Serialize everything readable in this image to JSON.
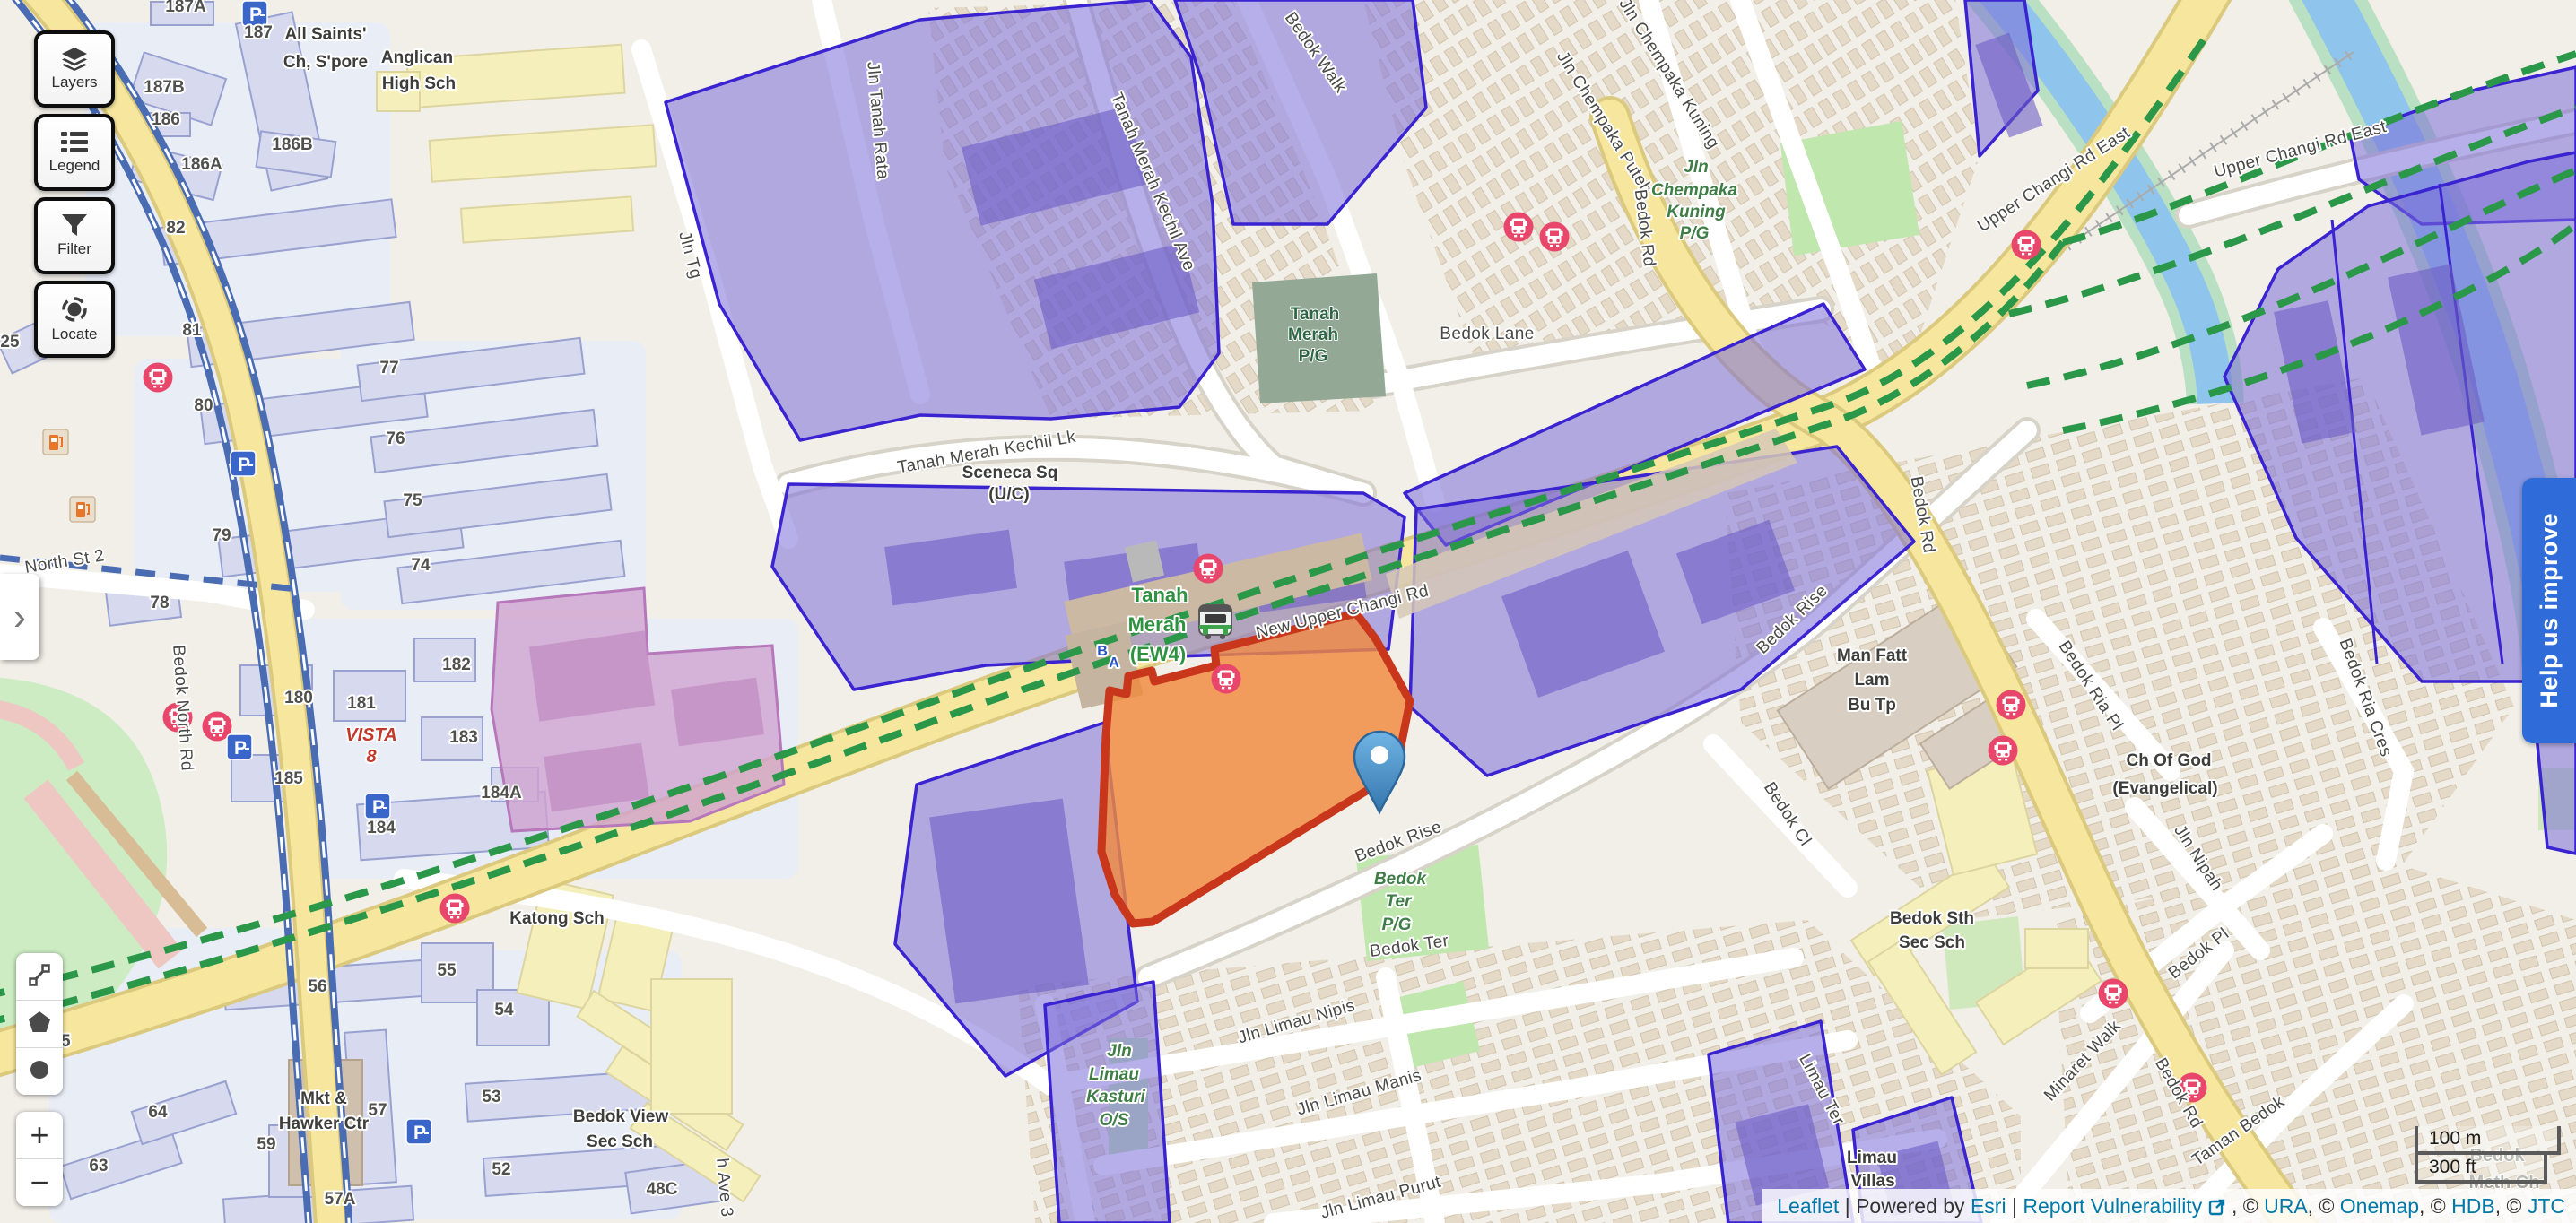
{
  "ui": {
    "buttons": [
      {
        "id": "layers",
        "label": "Layers"
      },
      {
        "id": "legend",
        "label": "Legend"
      },
      {
        "id": "filter",
        "label": "Filter"
      },
      {
        "id": "locate",
        "label": "Locate"
      }
    ],
    "panel_toggle": "›",
    "zoom_in": "+",
    "zoom_out": "−",
    "help_banner": "Help us improve",
    "scale": {
      "metric": "100 m",
      "imperial": "300 ft"
    },
    "attribution": {
      "leaflet": "Leaflet",
      "sep1": " | ",
      "powered": "Powered by ",
      "esri": "Esri",
      "sep2": " | ",
      "report": "Report Vulnerability",
      "after_icon": " , © ",
      "ura": "URA",
      "c2": ", © ",
      "onemap": "Onemap",
      "c3": ", © ",
      "hdb": "HDB",
      "c4": ", © ",
      "jtc": "JTC"
    }
  },
  "colors": {
    "purple_zone": "#7c6ed8",
    "purple_border": "#3a23d0",
    "orange_parcel": "#f08a3e",
    "orange_border": "#c8361b",
    "road_yellow": "#f7e79e",
    "park_green": "#bfe7ae",
    "transit_green": "#2b9748",
    "water_blue": "#8fc4ec",
    "marker_blue": "#3f85c4",
    "banner_blue": "#2f6cd9",
    "bus_pink": "#e8476b",
    "link_blue": "#0078a8"
  },
  "map": {
    "labels": [
      [
        "Bedok Walk",
        1462,
        62,
        55,
        "st"
      ],
      [
        "Jln Tanah Rata",
        973,
        135,
        85,
        "st"
      ],
      [
        "Jln Tg",
        764,
        286,
        75,
        "st"
      ],
      [
        "Tanah Merah Kechil Ave",
        1280,
        205,
        67,
        "st"
      ],
      [
        "Tanah Merah Kechil Lk",
        1101,
        510,
        -10,
        "st"
      ],
      [
        "Jln Chempaka Puteh",
        1784,
        140,
        58,
        "st"
      ],
      [
        "Jln Chempaka Kuning",
        1856,
        85,
        58,
        "st"
      ],
      [
        "Upper Changi Rd East",
        2293,
        205,
        -33,
        "st"
      ],
      [
        "Upper Changi Rd East",
        2566,
        172,
        -15,
        "st"
      ],
      [
        "Bedok Lane",
        1658,
        378,
        0,
        "st"
      ],
      [
        "Bedok Rd",
        1828,
        255,
        83,
        "st"
      ],
      [
        "New Upper Changi Rd",
        1498,
        688,
        -14,
        "st"
      ],
      [
        "Bedok Rise",
        2002,
        695,
        -44,
        "st"
      ],
      [
        "Bedok Rise",
        1561,
        944,
        -20,
        "st"
      ],
      [
        "Bedok Rd",
        2138,
        575,
        80,
        "st"
      ],
      [
        "Bedok Ria Cres",
        2632,
        780,
        70,
        "st"
      ],
      [
        "Bedok Ria Pl",
        2326,
        768,
        57,
        "st"
      ],
      [
        "Bedok Cl",
        1988,
        911,
        57,
        "st"
      ],
      [
        "Jln Nipah",
        2446,
        960,
        57,
        "st"
      ],
      [
        "Bedok Rd",
        2424,
        1222,
        60,
        "st"
      ],
      [
        "Bedok Pl",
        2455,
        1068,
        -38,
        "st"
      ],
      [
        "Minaret Walk",
        2326,
        1187,
        -47,
        "st"
      ],
      [
        "Taman Bedok",
        2499,
        1266,
        -35,
        "st"
      ],
      [
        "Jln Limau Nipis",
        1447,
        1145,
        -16,
        "st"
      ],
      [
        "Jln Limau Manis",
        1517,
        1224,
        -16,
        "st"
      ],
      [
        "Jln Limau Purut",
        1541,
        1341,
        -15,
        "st"
      ],
      [
        "North St 2",
        73,
        632,
        -9,
        "st"
      ],
      [
        "Bedok North Rd",
        198,
        790,
        86,
        "st"
      ],
      [
        "Limau Ter",
        2026,
        1218,
        62,
        "st"
      ],
      [
        "h Ave 3",
        802,
        1325,
        85,
        "st"
      ],
      [
        "Bedok Ter",
        1572,
        1061,
        -8,
        "st"
      ],
      [
        "All Saints'",
        363,
        44,
        0,
        "poi"
      ],
      [
        "Ch, S'pore",
        363,
        75,
        0,
        "poi"
      ],
      [
        "Anglican",
        465,
        70,
        0,
        "poi"
      ],
      [
        "High Sch",
        467,
        99,
        0,
        "poi"
      ],
      [
        "Sceneca Sq",
        1126,
        533,
        0,
        "poi"
      ],
      [
        "(U/C)",
        1125,
        557,
        0,
        "poi"
      ],
      [
        "Man Fatt",
        2087,
        737,
        0,
        "poi"
      ],
      [
        "Lam",
        2087,
        764,
        0,
        "poi"
      ],
      [
        "Bu Tp",
        2087,
        792,
        0,
        "poi"
      ],
      [
        "Katong Sch",
        621,
        1030,
        0,
        "poi"
      ],
      [
        "Bedok View",
        692,
        1251,
        0,
        "poi"
      ],
      [
        "Sec Sch",
        691,
        1279,
        0,
        "poi"
      ],
      [
        "Mkt &",
        361,
        1231,
        0,
        "poi"
      ],
      [
        "Hawker Ctr",
        361,
        1259,
        0,
        "poi"
      ],
      [
        "Bedok Sth",
        2154,
        1030,
        0,
        "poi"
      ],
      [
        "Sec Sch",
        2154,
        1057,
        0,
        "poi"
      ],
      [
        "Limau",
        2087,
        1297,
        0,
        "poi"
      ],
      [
        "Villas",
        2088,
        1323,
        0,
        "poi"
      ],
      [
        "Ch Of God",
        2418,
        854,
        0,
        "poi"
      ],
      [
        "(Evangelical)",
        2414,
        885,
        0,
        "poi"
      ],
      [
        "Bedok",
        2784,
        1295,
        0,
        "faint"
      ],
      [
        "Meth Ch",
        2792,
        1325,
        0,
        "faint"
      ],
      [
        "Jln",
        1891,
        192,
        0,
        "park"
      ],
      [
        "Chempaka",
        1889,
        218,
        0,
        "park"
      ],
      [
        "Kuning",
        1891,
        242,
        0,
        "park"
      ],
      [
        "P/G",
        1889,
        266,
        0,
        "park"
      ],
      [
        "Bedok",
        1561,
        986,
        0,
        "park"
      ],
      [
        "Ter",
        1559,
        1011,
        0,
        "park"
      ],
      [
        "P/G",
        1557,
        1037,
        0,
        "park"
      ],
      [
        "Jln",
        1248,
        1178,
        0,
        "park"
      ],
      [
        "Limau",
        1242,
        1204,
        0,
        "park"
      ],
      [
        "Kasturi",
        1244,
        1229,
        0,
        "park"
      ],
      [
        "O/S",
        1242,
        1255,
        0,
        "park"
      ],
      [
        "Tanah",
        1466,
        356,
        0,
        "parkd"
      ],
      [
        "Merah",
        1464,
        379,
        0,
        "parkd"
      ],
      [
        "P/G",
        1464,
        403,
        0,
        "parkd"
      ],
      [
        "Tanah",
        1293,
        671,
        0,
        "sta"
      ],
      [
        "Merah",
        1290,
        704,
        0,
        "sta"
      ],
      [
        "(EW4)",
        1291,
        737,
        0,
        "sta"
      ],
      [
        "B",
        1229,
        731,
        0,
        "exit"
      ],
      [
        "A",
        1242,
        744,
        0,
        "exit"
      ],
      [
        "VISTA",
        414,
        826,
        0,
        "red"
      ],
      [
        "8",
        414,
        850,
        0,
        "red"
      ],
      [
        "187A",
        207,
        13,
        0,
        "num"
      ],
      [
        "187",
        288,
        42,
        0,
        "num"
      ],
      [
        "187B",
        183,
        103,
        0,
        "num"
      ],
      [
        "186",
        185,
        139,
        0,
        "num"
      ],
      [
        "186B",
        326,
        167,
        0,
        "num"
      ],
      [
        "186A",
        225,
        189,
        0,
        "num"
      ],
      [
        "82",
        196,
        260,
        0,
        "num"
      ],
      [
        "81",
        214,
        374,
        0,
        "num"
      ],
      [
        "80",
        227,
        458,
        0,
        "num"
      ],
      [
        "79",
        247,
        603,
        0,
        "num"
      ],
      [
        "78",
        178,
        678,
        0,
        "num"
      ],
      [
        "77",
        434,
        416,
        0,
        "num"
      ],
      [
        "76",
        441,
        495,
        0,
        "num"
      ],
      [
        "75",
        460,
        564,
        0,
        "num"
      ],
      [
        "74",
        469,
        636,
        0,
        "num"
      ],
      [
        "25",
        11,
        387,
        0,
        "num"
      ],
      [
        "180",
        333,
        784,
        0,
        "num"
      ],
      [
        "181",
        403,
        790,
        0,
        "num"
      ],
      [
        "182",
        509,
        747,
        0,
        "num"
      ],
      [
        "183",
        517,
        828,
        0,
        "num"
      ],
      [
        "185",
        322,
        874,
        0,
        "num"
      ],
      [
        "184",
        425,
        929,
        0,
        "num"
      ],
      [
        "184A",
        559,
        890,
        0,
        "num"
      ],
      [
        "56",
        354,
        1106,
        0,
        "num"
      ],
      [
        "55",
        498,
        1088,
        0,
        "num"
      ],
      [
        "54",
        562,
        1132,
        0,
        "num"
      ],
      [
        "53",
        548,
        1229,
        0,
        "num"
      ],
      [
        "52",
        559,
        1310,
        0,
        "num"
      ],
      [
        "57",
        421,
        1244,
        0,
        "num"
      ],
      [
        "57A",
        379,
        1343,
        0,
        "num"
      ],
      [
        "48C",
        738,
        1332,
        0,
        "num"
      ],
      [
        "65",
        68,
        1167,
        0,
        "num"
      ],
      [
        "63",
        110,
        1306,
        0,
        "num"
      ],
      [
        "64",
        176,
        1246,
        0,
        "num"
      ],
      [
        "59",
        297,
        1282,
        0,
        "num"
      ]
    ],
    "icons": {
      "bus": [
        [
          176,
          421
        ],
        [
          198,
          800
        ],
        [
          242,
          810
        ],
        [
          507,
          1013
        ],
        [
          1347,
          634
        ],
        [
          1367,
          757
        ],
        [
          1693,
          253
        ],
        [
          1733,
          264
        ],
        [
          2259,
          273
        ],
        [
          2242,
          786
        ],
        [
          2233,
          837
        ],
        [
          2356,
          1108
        ],
        [
          2444,
          1213
        ]
      ],
      "parking": [
        [
          284,
          15
        ],
        [
          271,
          517
        ],
        [
          267,
          833
        ],
        [
          421,
          899
        ],
        [
          467,
          1262
        ]
      ],
      "petrol": [
        [
          62,
          493
        ],
        [
          92,
          568
        ]
      ],
      "train": [
        [
          1333,
          670
        ]
      ]
    }
  }
}
